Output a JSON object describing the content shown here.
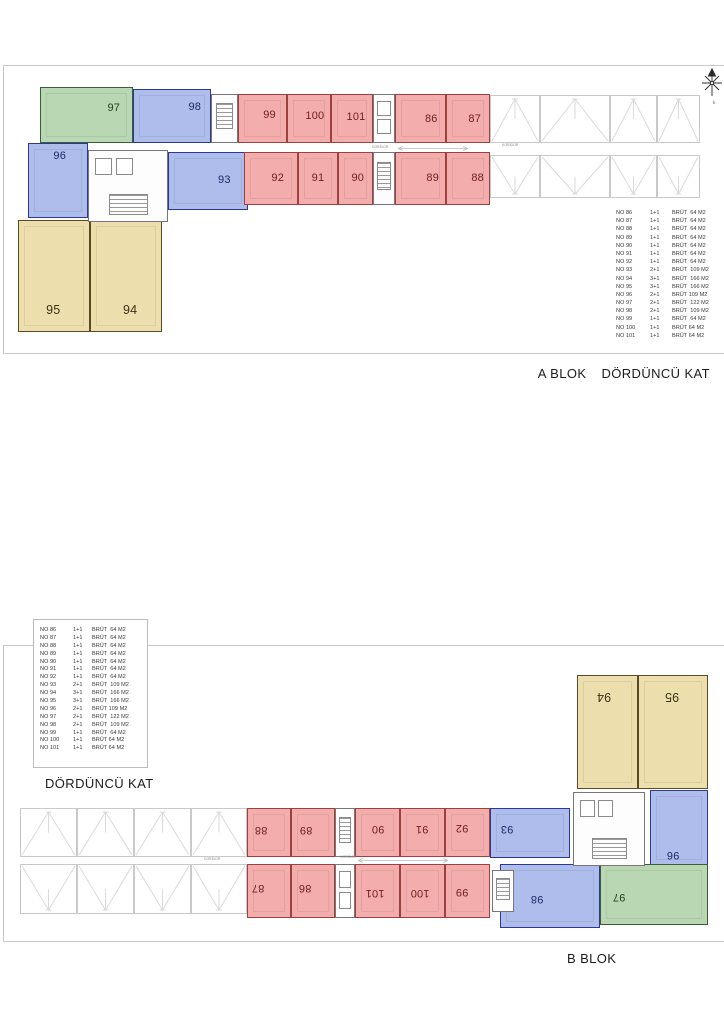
{
  "captions": {
    "a_block": "A BLOK",
    "a_floor": "DÖRDÜNCÜ KAT",
    "b_floor": "DÖRDÜNCÜ KAT",
    "b_block": "B BLOK"
  },
  "corridor_label": "KORİDOR",
  "colors": {
    "red": {
      "fill": "#f4adad",
      "wall": "#9c4040",
      "text": "#701d1d"
    },
    "blue": {
      "fill": "#aebdec",
      "wall": "#2b3a8e",
      "text": "#1d2b66"
    },
    "green": {
      "fill": "#b9d7b3",
      "wall": "#3c5c38",
      "text": "#24401f"
    },
    "yellow": {
      "fill": "#ecdfad",
      "wall": "#5a4a28",
      "text": "#3c3218"
    },
    "terrace_lines": "#dadada",
    "panel_border": "#c9c9c9",
    "legend_text": "#3a3a3a"
  },
  "legend": {
    "rows": [
      {
        "no": "NO 86",
        "plan": "1+1",
        "area": "BRÜT  64 M2"
      },
      {
        "no": "NO 87",
        "plan": "1+1",
        "area": "BRÜT  64 M2"
      },
      {
        "no": "NO 88",
        "plan": "1+1",
        "area": "BRÜT  64 M2"
      },
      {
        "no": "NO 89",
        "plan": "1+1",
        "area": "BRÜT  64 M2"
      },
      {
        "no": "NO 90",
        "plan": "1+1",
        "area": "BRÜT  64 M2"
      },
      {
        "no": "NO 91",
        "plan": "1+1",
        "area": "BRÜT  64 M2"
      },
      {
        "no": "NO 92",
        "plan": "1+1",
        "area": "BRÜT  64 M2"
      },
      {
        "no": "NO 93",
        "plan": "2+1",
        "area": "BRÜT  109 M2"
      },
      {
        "no": "NO 94",
        "plan": "3+1",
        "area": "BRÜT  166 M2"
      },
      {
        "no": "NO 95",
        "plan": "3+1",
        "area": "BRÜT  166 M2"
      },
      {
        "no": "NO 96",
        "plan": "2+1",
        "area": "BRÜT 109 M2"
      },
      {
        "no": "NO 97",
        "plan": "2+1",
        "area": "BRÜT  122 M2"
      },
      {
        "no": "NO 98",
        "plan": "2+1",
        "area": "BRÜT  109 M2"
      },
      {
        "no": "NO 99",
        "plan": "1+1",
        "area": "BRÜT  64 M2"
      },
      {
        "no": "NO 100",
        "plan": "1+1",
        "area": "BRÜT 64 M2"
      },
      {
        "no": "NO 101",
        "plan": "1+1",
        "area": "BRÜT 64 M2"
      }
    ]
  },
  "plan_a": {
    "units": [
      {
        "no": "97",
        "c": "green",
        "x": 40,
        "y": 87,
        "w": 93,
        "h": 56,
        "lx": 0.8,
        "ly": 0.37,
        "rot": false
      },
      {
        "no": "98",
        "c": "blue",
        "x": 133,
        "y": 89,
        "w": 78,
        "h": 54,
        "lx": 0.8,
        "ly": 0.33,
        "rot": false
      },
      {
        "no": "99",
        "c": "red",
        "x": 238,
        "y": 94,
        "w": 49,
        "h": 49,
        "lx": 0.65,
        "ly": 0.43,
        "rot": false
      },
      {
        "no": "100",
        "c": "red",
        "x": 287,
        "y": 94,
        "w": 44,
        "h": 49,
        "lx": 0.64,
        "ly": 0.45,
        "rot": false
      },
      {
        "no": "101",
        "c": "red",
        "x": 331,
        "y": 94,
        "w": 42,
        "h": 49,
        "lx": 0.6,
        "ly": 0.47,
        "rot": false
      },
      {
        "no": "86",
        "c": "red",
        "x": 395,
        "y": 94,
        "w": 51,
        "h": 49,
        "lx": 0.72,
        "ly": 0.5,
        "rot": false
      },
      {
        "no": "87",
        "c": "red",
        "x": 446,
        "y": 94,
        "w": 44,
        "h": 49,
        "lx": 0.66,
        "ly": 0.5,
        "rot": false
      },
      {
        "no": "96",
        "c": "blue",
        "x": 28,
        "y": 143,
        "w": 60,
        "h": 75,
        "lx": 0.53,
        "ly": 0.16,
        "rot": false
      },
      {
        "no": "93",
        "c": "blue",
        "x": 168,
        "y": 152,
        "w": 80,
        "h": 58,
        "lx": 0.71,
        "ly": 0.48,
        "rot": false
      },
      {
        "no": "92",
        "c": "red",
        "x": 244,
        "y": 152,
        "w": 54,
        "h": 53,
        "lx": 0.63,
        "ly": 0.49,
        "rot": false
      },
      {
        "no": "91",
        "c": "red",
        "x": 298,
        "y": 152,
        "w": 40,
        "h": 53,
        "lx": 0.5,
        "ly": 0.49,
        "rot": false
      },
      {
        "no": "90",
        "c": "red",
        "x": 338,
        "y": 152,
        "w": 35,
        "h": 53,
        "lx": 0.57,
        "ly": 0.49,
        "rot": false
      },
      {
        "no": "89",
        "c": "red",
        "x": 395,
        "y": 152,
        "w": 51,
        "h": 53,
        "lx": 0.75,
        "ly": 0.49,
        "rot": false
      },
      {
        "no": "88",
        "c": "red",
        "x": 446,
        "y": 152,
        "w": 44,
        "h": 53,
        "lx": 0.73,
        "ly": 0.49,
        "rot": false
      },
      {
        "no": "95",
        "c": "yellow",
        "x": 18,
        "y": 220,
        "w": 72,
        "h": 112,
        "lx": 0.49,
        "ly": 0.81,
        "rot": false
      },
      {
        "no": "94",
        "c": "yellow",
        "x": 90,
        "y": 220,
        "w": 72,
        "h": 112,
        "lx": 0.56,
        "ly": 0.81,
        "rot": false
      }
    ],
    "terraces": [
      {
        "x": 490,
        "y": 95,
        "w": 50,
        "h": 48,
        "dir": "up"
      },
      {
        "x": 540,
        "y": 95,
        "w": 70,
        "h": 48,
        "dir": "up"
      },
      {
        "x": 610,
        "y": 95,
        "w": 47,
        "h": 48,
        "dir": "up"
      },
      {
        "x": 657,
        "y": 95,
        "w": 43,
        "h": 48,
        "dir": "up"
      },
      {
        "x": 490,
        "y": 155,
        "w": 50,
        "h": 43,
        "dir": "down"
      },
      {
        "x": 540,
        "y": 155,
        "w": 70,
        "h": 43,
        "dir": "down"
      },
      {
        "x": 610,
        "y": 155,
        "w": 47,
        "h": 43,
        "dir": "down"
      },
      {
        "x": 657,
        "y": 155,
        "w": 43,
        "h": 43,
        "dir": "down"
      }
    ],
    "cores": [
      {
        "x": 211,
        "y": 94,
        "w": 27,
        "h": 49,
        "kind": "stair"
      },
      {
        "x": 373,
        "y": 94,
        "w": 22,
        "h": 49,
        "kind": "lift"
      },
      {
        "x": 88,
        "y": 150,
        "w": 80,
        "h": 72,
        "kind": "lobby"
      },
      {
        "x": 373,
        "y": 152,
        "w": 22,
        "h": 53,
        "kind": "stair"
      }
    ],
    "corridor": {
      "labels": [
        {
          "x": 372,
          "y": 145
        },
        {
          "x": 502,
          "y": 143
        }
      ],
      "bar": {
        "x": 398,
        "y": 146,
        "w": 70
      }
    }
  },
  "plan_b": {
    "units": [
      {
        "no": "88",
        "c": "red",
        "x": 247,
        "y": 808,
        "w": 44,
        "h": 49,
        "lx": 0.3,
        "ly": 0.45,
        "rot": true
      },
      {
        "no": "89",
        "c": "red",
        "x": 291,
        "y": 808,
        "w": 44,
        "h": 49,
        "lx": 0.34,
        "ly": 0.45,
        "rot": true
      },
      {
        "no": "90",
        "c": "red",
        "x": 355,
        "y": 808,
        "w": 45,
        "h": 49,
        "lx": 0.51,
        "ly": 0.43,
        "rot": true
      },
      {
        "no": "91",
        "c": "red",
        "x": 400,
        "y": 808,
        "w": 45,
        "h": 49,
        "lx": 0.49,
        "ly": 0.43,
        "rot": true
      },
      {
        "no": "92",
        "c": "red",
        "x": 445,
        "y": 808,
        "w": 45,
        "h": 49,
        "lx": 0.38,
        "ly": 0.41,
        "rot": true
      },
      {
        "no": "93",
        "c": "blue",
        "x": 490,
        "y": 808,
        "w": 80,
        "h": 50,
        "lx": 0.21,
        "ly": 0.42,
        "rot": true
      },
      {
        "no": "96",
        "c": "blue",
        "x": 650,
        "y": 790,
        "w": 58,
        "h": 76,
        "lx": 0.4,
        "ly": 0.86,
        "rot": true
      },
      {
        "no": "87",
        "c": "red",
        "x": 247,
        "y": 864,
        "w": 44,
        "h": 54,
        "lx": 0.23,
        "ly": 0.44,
        "rot": true
      },
      {
        "no": "86",
        "c": "red",
        "x": 291,
        "y": 864,
        "w": 44,
        "h": 54,
        "lx": 0.32,
        "ly": 0.44,
        "rot": true
      },
      {
        "no": "101",
        "c": "red",
        "x": 355,
        "y": 864,
        "w": 45,
        "h": 54,
        "lx": 0.44,
        "ly": 0.54,
        "rot": true
      },
      {
        "no": "100",
        "c": "red",
        "x": 400,
        "y": 864,
        "w": 45,
        "h": 54,
        "lx": 0.44,
        "ly": 0.54,
        "rot": true
      },
      {
        "no": "99",
        "c": "red",
        "x": 445,
        "y": 864,
        "w": 45,
        "h": 54,
        "lx": 0.38,
        "ly": 0.52,
        "rot": true
      },
      {
        "no": "98",
        "c": "blue",
        "x": 500,
        "y": 864,
        "w": 100,
        "h": 64,
        "lx": 0.37,
        "ly": 0.55,
        "rot": true
      },
      {
        "no": "97",
        "c": "green",
        "x": 600,
        "y": 864,
        "w": 108,
        "h": 61,
        "lx": 0.17,
        "ly": 0.55,
        "rot": true
      },
      {
        "no": "94",
        "c": "yellow",
        "x": 577,
        "y": 675,
        "w": 61,
        "h": 114,
        "lx": 0.44,
        "ly": 0.19,
        "rot": true
      },
      {
        "no": "95",
        "c": "yellow",
        "x": 638,
        "y": 675,
        "w": 70,
        "h": 114,
        "lx": 0.49,
        "ly": 0.19,
        "rot": true
      }
    ],
    "terraces": [
      {
        "x": 20,
        "y": 808,
        "w": 57,
        "h": 49,
        "dir": "up"
      },
      {
        "x": 77,
        "y": 808,
        "w": 57,
        "h": 49,
        "dir": "up"
      },
      {
        "x": 134,
        "y": 808,
        "w": 57,
        "h": 49,
        "dir": "up"
      },
      {
        "x": 191,
        "y": 808,
        "w": 56,
        "h": 49,
        "dir": "up"
      },
      {
        "x": 20,
        "y": 864,
        "w": 57,
        "h": 50,
        "dir": "down"
      },
      {
        "x": 77,
        "y": 864,
        "w": 57,
        "h": 50,
        "dir": "down"
      },
      {
        "x": 134,
        "y": 864,
        "w": 57,
        "h": 50,
        "dir": "down"
      },
      {
        "x": 191,
        "y": 864,
        "w": 56,
        "h": 50,
        "dir": "down"
      }
    ],
    "cores": [
      {
        "x": 335,
        "y": 808,
        "w": 20,
        "h": 49,
        "kind": "stair"
      },
      {
        "x": 573,
        "y": 792,
        "w": 72,
        "h": 74,
        "kind": "lobby"
      },
      {
        "x": 335,
        "y": 864,
        "w": 20,
        "h": 54,
        "kind": "lift"
      },
      {
        "x": 492,
        "y": 870,
        "w": 22,
        "h": 42,
        "kind": "stair"
      }
    ],
    "corridor": {
      "labels": [
        {
          "x": 204,
          "y": 857
        },
        {
          "x": 340,
          "y": 855
        }
      ],
      "bar": {
        "x": 358,
        "y": 858,
        "w": 90
      }
    }
  }
}
